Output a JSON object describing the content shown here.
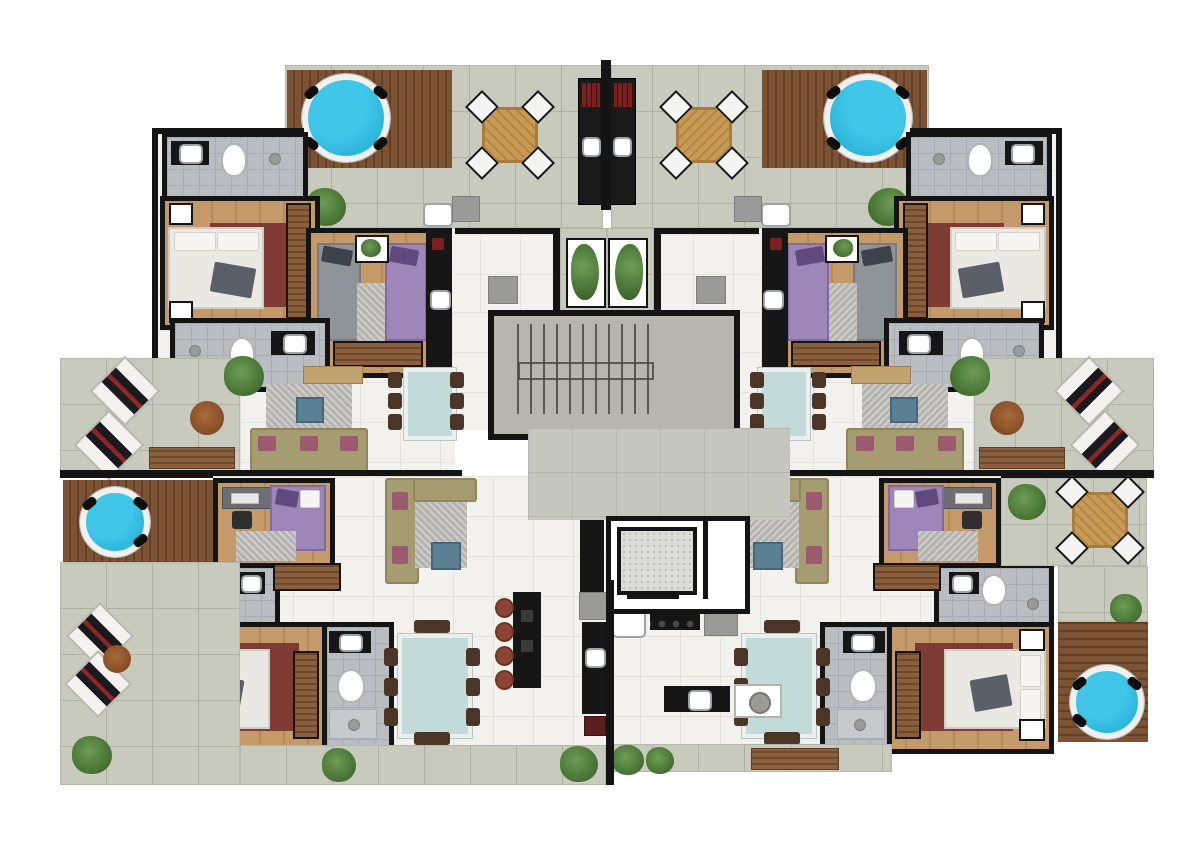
{
  "document": {
    "type": "architectural-floor-plan",
    "view": "top-down color rendering of a residential floor with two mirrored apartment wings",
    "text_labels": []
  },
  "palette": {
    "wall": "#141414",
    "terrace_tile": "#c7cabc",
    "terrace_grout": "#adb1a3",
    "interior_floor": "#f2f1ed",
    "interior_grout": "#e3e2dd",
    "hall_tile": "#c6c6c0",
    "bath_floor": "#b9bdc2",
    "bath_grout": "#a9adb3",
    "deck_wood": "#7b5233",
    "deck_wood_dark": "#643f23",
    "room_wood": "#c49a6b",
    "room_wood_dark": "#b48a5a",
    "pool_water": "#3fc6e8",
    "pool_water_deep": "#1ea6cf",
    "pool_ring": "#f0f0ee",
    "concrete": "#b7b6ae",
    "rug_red": "#7d3b33",
    "rug_gray": "#b5b3af",
    "sofa_olive": "#a59c72",
    "sofa_edge": "#8e865f",
    "cushion_pink": "#9c5a6e",
    "glass_table": "#c2dbd9",
    "chair_dark": "#4a3526",
    "wood_table": "#c79a58",
    "stool_red": "#8c4534",
    "plant_green": "#4d7a39",
    "plant_dark": "#3a5e2a",
    "bench_wood": "#8a5f3d",
    "counter_black": "#161616",
    "grill_red": "#7a2020",
    "bed_white": "#eae8e3",
    "bed_gray": "#8f939a",
    "bed_purple": "#9d86b8",
    "pillow_dark": "#5a5f68",
    "appliance_gray": "#9a9a98",
    "ottoman_blue": "#5b7f93"
  },
  "inventory": {
    "shared_core": [
      "staircase",
      "elevator",
      "entry-hall",
      "planter-boxes"
    ],
    "per_wing_rooms": [
      "roof-terrace-with-jacuzzi",
      "barbecue-counter",
      "bathroom",
      "master-bedroom",
      "twin-bedroom",
      "kitchen-counter",
      "living-room",
      "dining-room",
      "office-bedroom",
      "lower-master-bedroom",
      "second-bathroom",
      "third-bathroom"
    ],
    "outdoor_features": [
      "round-jacuzzi x4",
      "octagonal-table x3",
      "lounge-chairs",
      "wood-benches",
      "shrub-planters",
      "wood-decks"
    ]
  }
}
